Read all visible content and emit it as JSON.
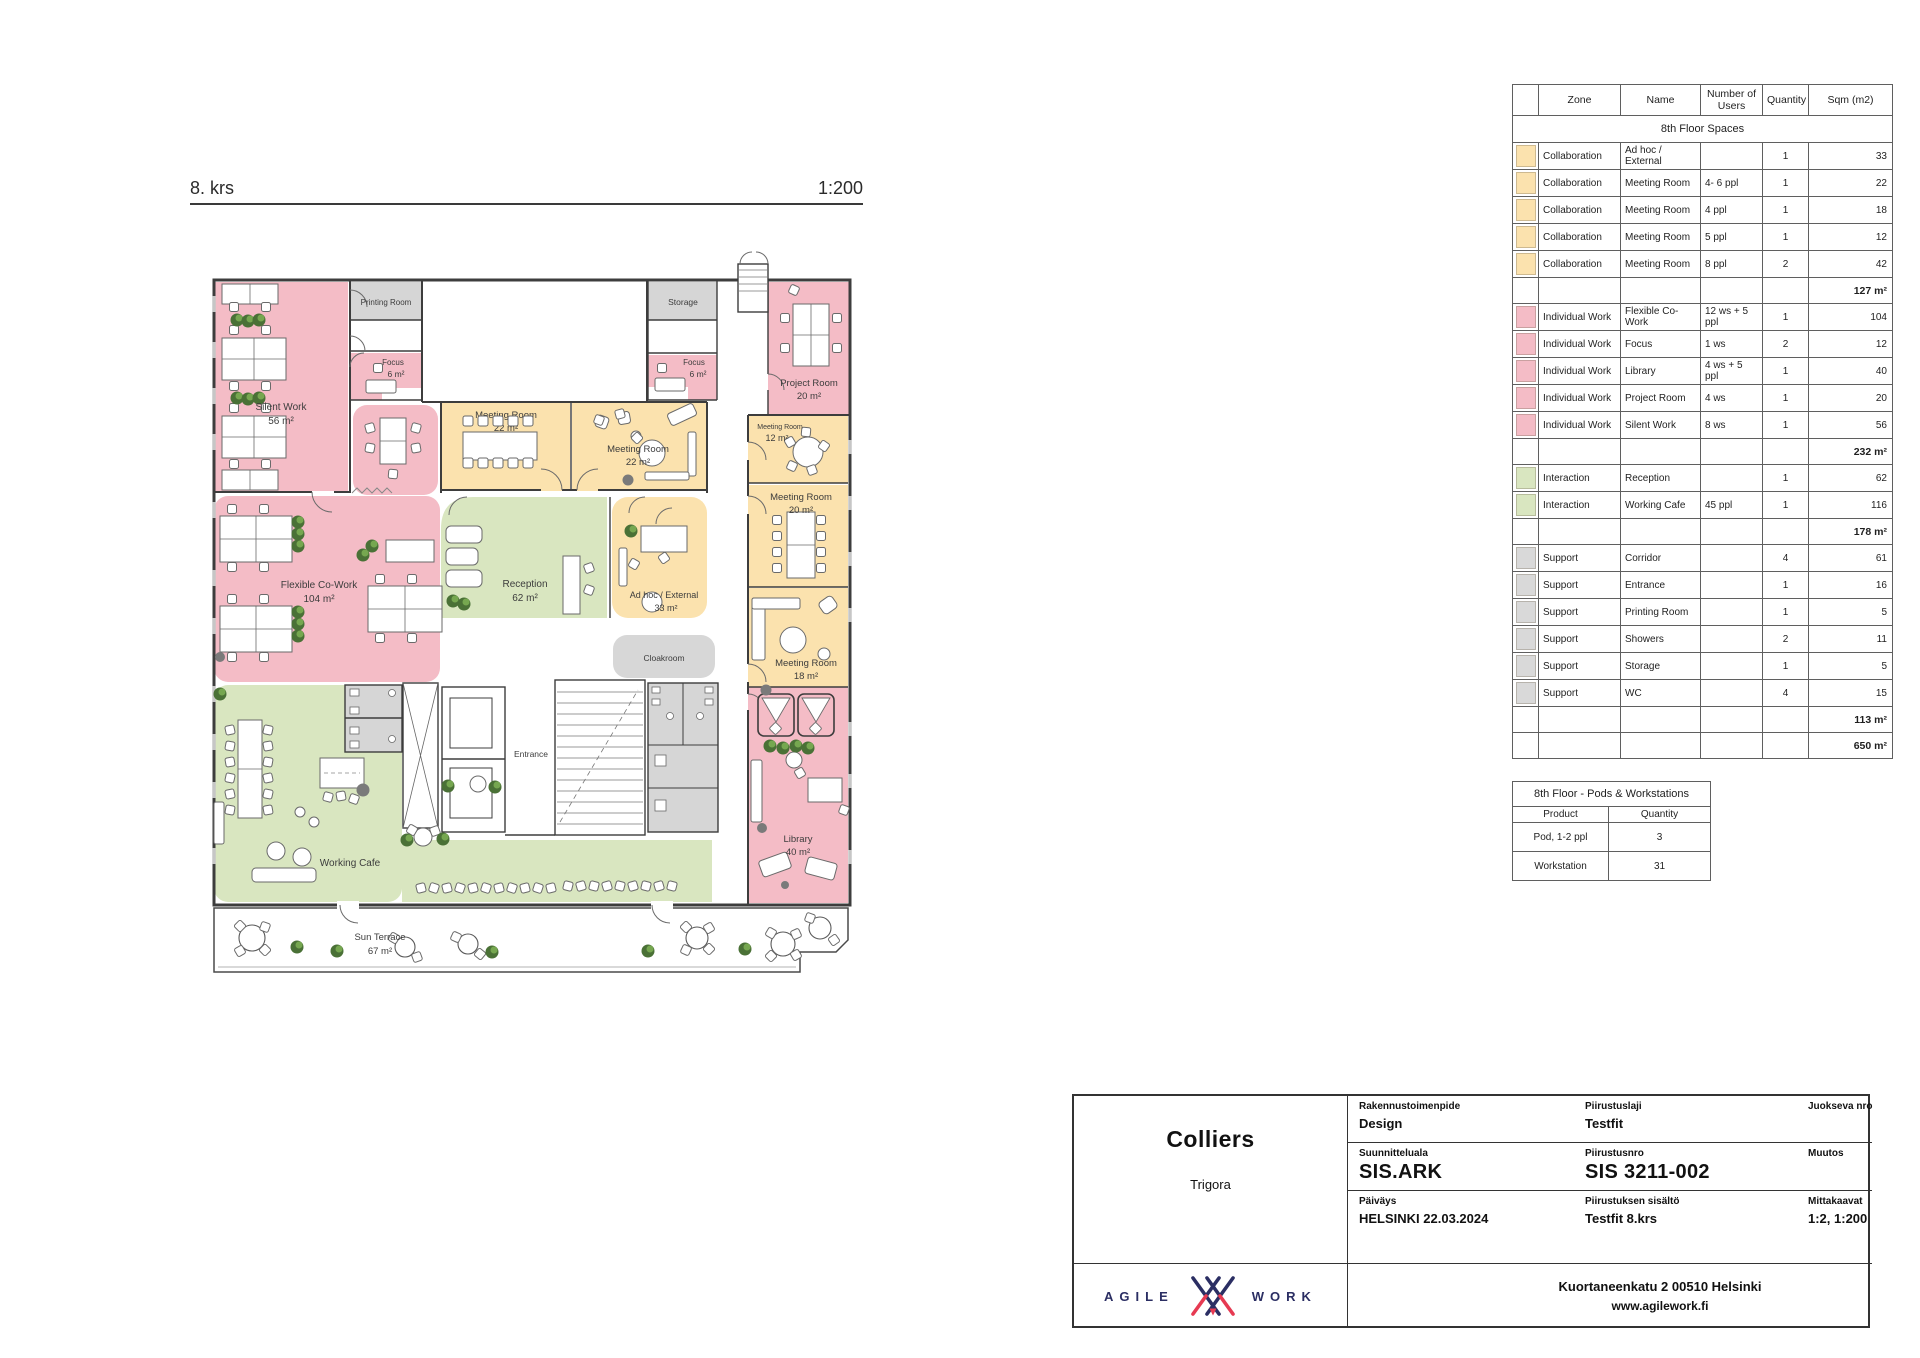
{
  "document": {
    "floor_label": "8. krs",
    "scale_label": "1:200"
  },
  "colors": {
    "collaboration": "#fbe2ae",
    "individual_work": "#f4bcc6",
    "interaction": "#d9e6c0",
    "support": "#d9d9d9",
    "wall": "#3d3d3d",
    "brand_navy": "#2b2e63",
    "brand_red": "#e63a52"
  },
  "spaces_table": {
    "title": "8th Floor Spaces",
    "columns": [
      "",
      "Zone",
      "Name",
      "Number of Users",
      "Quantity",
      "Sqm (m2)"
    ],
    "rows": [
      {
        "type": "data",
        "cat": "collaboration",
        "zone": "Collaboration",
        "name": "Ad hoc / External",
        "users": "",
        "qty": "1",
        "sqm": "33"
      },
      {
        "type": "data",
        "cat": "collaboration",
        "zone": "Collaboration",
        "name": "Meeting Room",
        "users": "4- 6 ppl",
        "qty": "1",
        "sqm": "22"
      },
      {
        "type": "data",
        "cat": "collaboration",
        "zone": "Collaboration",
        "name": "Meeting Room",
        "users": "4 ppl",
        "qty": "1",
        "sqm": "18"
      },
      {
        "type": "data",
        "cat": "collaboration",
        "zone": "Collaboration",
        "name": "Meeting Room",
        "users": "5 ppl",
        "qty": "1",
        "sqm": "12"
      },
      {
        "type": "data",
        "cat": "collaboration",
        "zone": "Collaboration",
        "name": "Meeting Room",
        "users": "8 ppl",
        "qty": "2",
        "sqm": "42"
      },
      {
        "type": "subtotal",
        "sqm": "127 m²"
      },
      {
        "type": "data",
        "cat": "individual_work",
        "zone": "Individual Work",
        "name": "Flexible Co-Work",
        "users": "12 ws + 5 ppl",
        "qty": "1",
        "sqm": "104"
      },
      {
        "type": "data",
        "cat": "individual_work",
        "zone": "Individual Work",
        "name": "Focus",
        "users": "1 ws",
        "qty": "2",
        "sqm": "12"
      },
      {
        "type": "data",
        "cat": "individual_work",
        "zone": "Individual Work",
        "name": "Library",
        "users": "4 ws + 5 ppl",
        "qty": "1",
        "sqm": "40"
      },
      {
        "type": "data",
        "cat": "individual_work",
        "zone": "Individual Work",
        "name": "Project Room",
        "users": "4 ws",
        "qty": "1",
        "sqm": "20"
      },
      {
        "type": "data",
        "cat": "individual_work",
        "zone": "Individual Work",
        "name": "Silent Work",
        "users": "8 ws",
        "qty": "1",
        "sqm": "56"
      },
      {
        "type": "subtotal",
        "sqm": "232 m²"
      },
      {
        "type": "data",
        "cat": "interaction",
        "zone": "Interaction",
        "name": "Reception",
        "users": "",
        "qty": "1",
        "sqm": "62"
      },
      {
        "type": "data",
        "cat": "interaction",
        "zone": "Interaction",
        "name": "Working Cafe",
        "users": "45 ppl",
        "qty": "1",
        "sqm": "116"
      },
      {
        "type": "subtotal",
        "sqm": "178 m²"
      },
      {
        "type": "data",
        "cat": "support",
        "zone": "Support",
        "name": "Corridor",
        "users": "",
        "qty": "4",
        "sqm": "61"
      },
      {
        "type": "data",
        "cat": "support",
        "zone": "Support",
        "name": "Entrance",
        "users": "",
        "qty": "1",
        "sqm": "16"
      },
      {
        "type": "data",
        "cat": "support",
        "zone": "Support",
        "name": "Printing Room",
        "users": "",
        "qty": "1",
        "sqm": "5"
      },
      {
        "type": "data",
        "cat": "support",
        "zone": "Support",
        "name": "Showers",
        "users": "",
        "qty": "2",
        "sqm": "11"
      },
      {
        "type": "data",
        "cat": "support",
        "zone": "Support",
        "name": "Storage",
        "users": "",
        "qty": "1",
        "sqm": "5"
      },
      {
        "type": "data",
        "cat": "support",
        "zone": "Support",
        "name": "WC",
        "users": "",
        "qty": "4",
        "sqm": "15"
      },
      {
        "type": "subtotal",
        "sqm": "113 m²"
      },
      {
        "type": "total",
        "sqm": "650 m²"
      }
    ]
  },
  "pods_table": {
    "title": "8th Floor - Pods & Workstations",
    "columns": [
      "Product",
      "Quantity"
    ],
    "rows": [
      {
        "product": "Pod, 1-2 ppl",
        "qty": "3"
      },
      {
        "product": "Workstation",
        "qty": "31"
      }
    ]
  },
  "plan": {
    "rooms": {
      "silent_work": {
        "name": "Silent Work",
        "area": "56 m²"
      },
      "flexible_cowork": {
        "name": "Flexible Co-Work",
        "area": "104 m²"
      },
      "printing_room": {
        "name": "Printing Room"
      },
      "focus_left": {
        "name": "Focus",
        "area": "6 m²"
      },
      "focus_right": {
        "name": "Focus",
        "area": "6 m²"
      },
      "storage": {
        "name": "Storage"
      },
      "project_room": {
        "name": "Project Room",
        "area": "20 m²"
      },
      "meeting_room_a": {
        "name": "Meeting Room",
        "area": "22 m²"
      },
      "meeting_room_b": {
        "name": "Meeting Room",
        "area": "22 m²"
      },
      "meeting_room_12": {
        "name": "Meeting Room",
        "area": "12 m²"
      },
      "meeting_room_20": {
        "name": "Meeting Room",
        "area": "20 m²"
      },
      "meeting_room_18": {
        "name": "Meeting Room",
        "area": "18 m²"
      },
      "ad_hoc": {
        "name": "Ad hoc / External",
        "area": "33 m²"
      },
      "reception": {
        "name": "Reception",
        "area": "62 m²"
      },
      "cloakroom": {
        "name": "Cloakroom"
      },
      "entrance": {
        "name": "Entrance"
      },
      "working_cafe": {
        "name": "Working Cafe"
      },
      "library": {
        "name": "Library",
        "area": "40 m²"
      },
      "sun_terrace": {
        "name": "Sun Terrace",
        "area": "67 m²"
      }
    }
  },
  "title_block": {
    "company": "Colliers",
    "project": "Trigora",
    "fields": [
      {
        "label": "Rakennustoimenpide",
        "value": "Design"
      },
      {
        "label": "Piirustuslaji",
        "value": "Testfit"
      },
      {
        "label": "Juokseva nro",
        "value": ""
      },
      {
        "label": "Suunnitteluala",
        "value": "SIS.ARK"
      },
      {
        "label": "Piirustusnro",
        "value": "SIS 3211-002"
      },
      {
        "label": "Muutos",
        "value": ""
      },
      {
        "label": "Päiväys",
        "value": "HELSINKI 22.03.2024"
      },
      {
        "label": "Piirustuksen sisältö",
        "value": "Testfit 8.krs"
      },
      {
        "label": "Mittakaavat",
        "value": "1:2, 1:200"
      }
    ],
    "brand": {
      "word1": "AGILE",
      "word2": "WORK"
    },
    "address": "Kuortaneenkatu 2 00510 Helsinki",
    "website": "www.agilework.fi"
  }
}
